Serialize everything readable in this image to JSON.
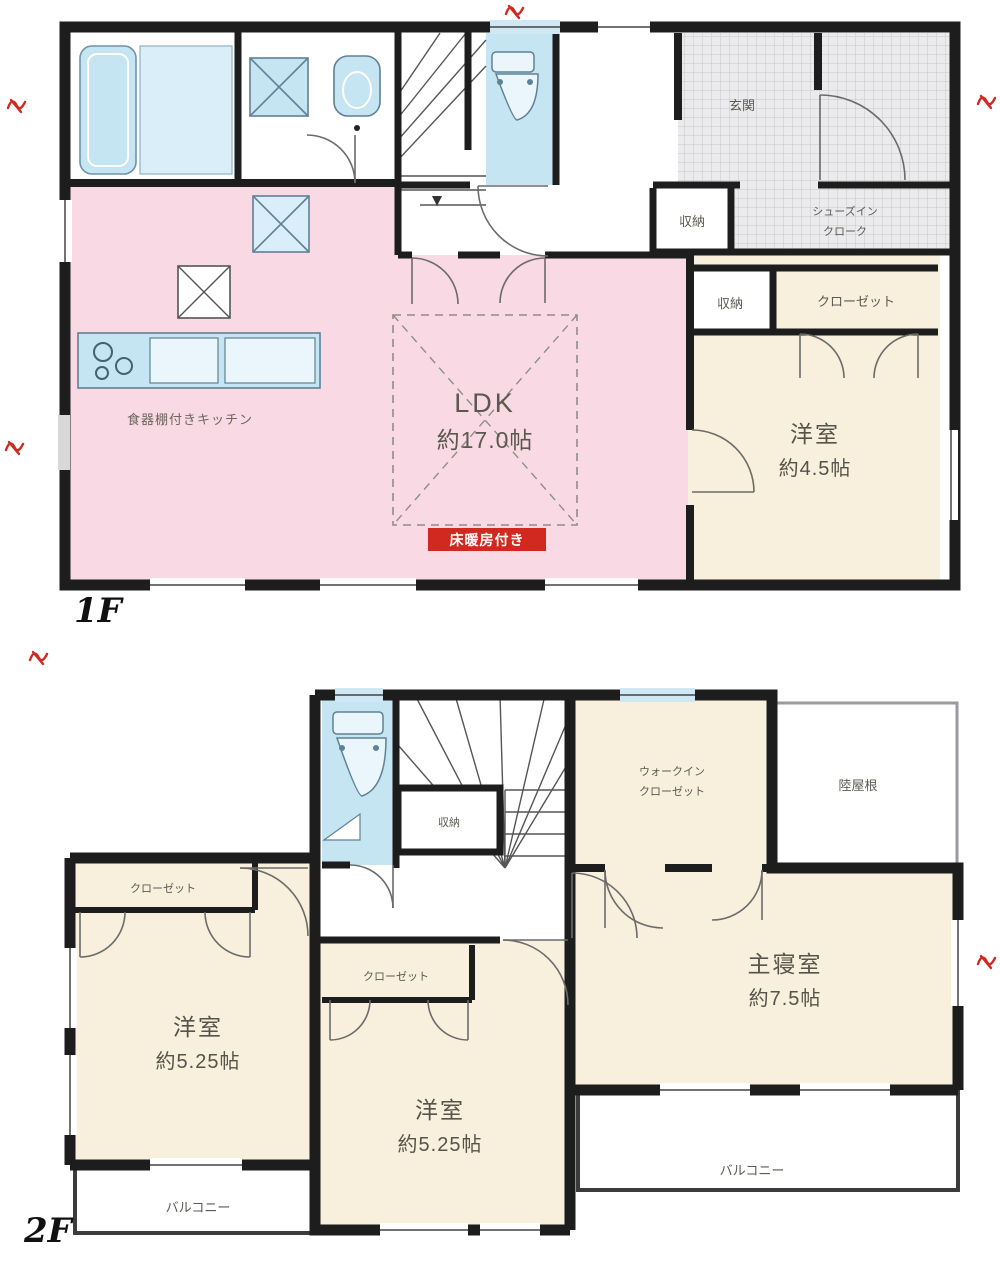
{
  "colors": {
    "wall": "#1d1d1d",
    "ldk_pink": "#f8d9e4",
    "room_cream": "#f8efdc",
    "water_cyan": "#c5e5f3",
    "tile_bg": "#ebebed",
    "tile_line": "#c7c7cb",
    "red_accent": "#d1281f"
  },
  "floor1": {
    "floor_label": "1F",
    "ldk_name": "LDK",
    "ldk_size": "約17.0帖",
    "kitchen_note": "食器棚付きキッチン",
    "red_badge": "床暖房付き",
    "youshitsu_name": "洋室",
    "youshitsu_size": "約4.5帖",
    "closet": "クローゼット",
    "storage_a": "収納",
    "storage_b": "収納",
    "genkan": "玄関",
    "shoes_line1": "シューズイン",
    "shoes_line2": "クローク"
  },
  "floor2": {
    "floor_label": "2F",
    "master_name": "主寝室",
    "master_size": "約7.5帖",
    "wic_line1": "ウォークイン",
    "wic_line2": "クローゼット",
    "roof_label": "陸屋根",
    "room_left_name": "洋室",
    "room_left_size": "約5.25帖",
    "room_center_name": "洋室",
    "room_center_size": "約5.25帖",
    "closet_left": "クローゼット",
    "closet_center": "クローゼット",
    "storage": "収納",
    "balcony_left": "バルコニー",
    "balcony_right": "バルコニー"
  },
  "annotations": {
    "marks": [
      {
        "x": 506,
        "y": 2
      },
      {
        "x": 8,
        "y": 96
      },
      {
        "x": 6,
        "y": 438
      },
      {
        "x": 978,
        "y": 92
      },
      {
        "x": 30,
        "y": 648
      },
      {
        "x": 978,
        "y": 952
      }
    ]
  }
}
